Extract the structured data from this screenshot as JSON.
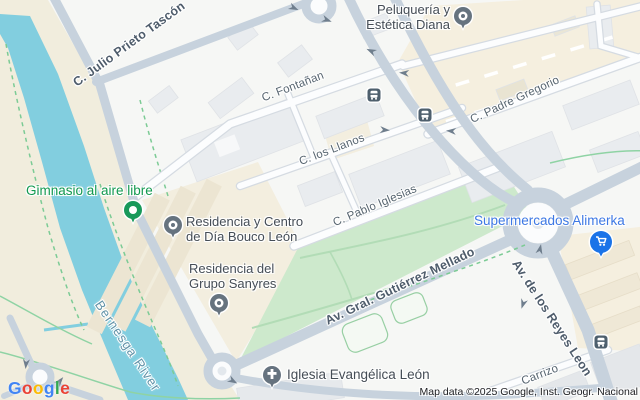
{
  "map": {
    "streets": {
      "julio_prieto": "C. Julio Prieto Tascón",
      "fontanan": "C. Fontañan",
      "los_llanos": "C. los Llanos",
      "pablo_iglesias": "C. Pablo Iglesias",
      "gutierrez_mellado": "Av. Gral. Gutiérrez Mellado",
      "padre_gregorio": "C. Padre Gregorio",
      "reyes_leon": "Av. de los Reyes Leon",
      "carrizo": "Carrizo",
      "river": "Bernesga River"
    },
    "pois": {
      "peluqueria_line1": "Peluquería y",
      "peluqueria_line2": "Estética Diana",
      "gimnasio": "Gimnasio al aire libre",
      "bouco_line1": "Residencia y Centro",
      "bouco_line2": "de Día Bouco León",
      "sanyres_line1": "Residencia del",
      "sanyres_line2": "Grupo Sanyres",
      "alimerka": "Supermercados Alimerka",
      "iglesia": "Iglesia Evangélica León"
    },
    "attribution": "Map data ©2025 Google, Inst. Geogr. Nacional",
    "logo": {
      "l0": "G",
      "l1": "o",
      "l2": "o",
      "l3": "g",
      "l4": "l",
      "l5": "e"
    },
    "colors": {
      "water": "#82cedf",
      "park": "#cde9cc",
      "riverbank": "#f1eddd",
      "road_major": "#c7d2dd",
      "cream_block": "#f5efdf",
      "trail_green": "#7ccb95",
      "poi_green": "#12994f",
      "poi_blue": "#3d78e4",
      "pin_gray": "#66737f",
      "pin_blue": "#1a73e8",
      "google_blue": "#4285F4",
      "google_red": "#EA4335",
      "google_yellow": "#FBBC05",
      "google_green": "#34A853"
    }
  }
}
